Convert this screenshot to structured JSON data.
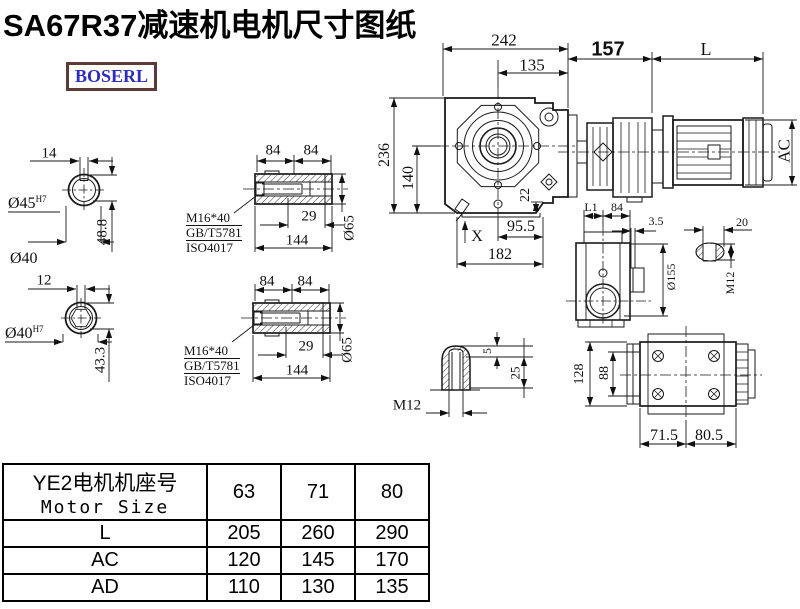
{
  "title": "SA67R37减速机电机尺寸图纸",
  "brand": {
    "logo_text": "BOSERL",
    "logo_color": "#2a2ad0",
    "border_color": "#5d3a3a"
  },
  "views": {
    "shaft_end_a": {
      "keyway_width": "14",
      "bore_dia": "Ø45",
      "bore_fit": "H7",
      "depth": "48.8",
      "outer_dia": "Ø40"
    },
    "shaft_end_b": {
      "keyway_width": "12",
      "bore_dia": "Ø40",
      "bore_fit": "H7",
      "depth": "43.3"
    },
    "hollow_shaft_a": {
      "half_len_1": "84",
      "half_len_2": "84",
      "bolt_len": "29",
      "total_len": "144",
      "outer_dia": "Ø65",
      "bolt_spec": "M16*40",
      "bolt_std_1": "GB/T5781",
      "bolt_std_2": "ISO4017"
    },
    "hollow_shaft_b": {
      "half_len_1": "84",
      "half_len_2": "84",
      "bolt_len": "29",
      "total_len": "144",
      "outer_dia": "Ø65",
      "bolt_spec": "M16*40",
      "bolt_std_1": "GB/T5781",
      "bolt_std_2": "ISO4017"
    },
    "front_view": {
      "overall_width": "242",
      "center_to_flange": "135",
      "gear_unit_len": "157",
      "motor_len": "L",
      "overall_height": "236",
      "center_height": "140",
      "foot_height": "22",
      "foot_to_center": "95.5",
      "base_width": "182",
      "x_mark": "X",
      "motor_dia": "AC"
    },
    "side_view": {
      "dim_l1": "L1",
      "flange_w": "84",
      "plate_t": "3.5",
      "flange_dia": "Ø155",
      "key_len": "20",
      "thread": "M12"
    },
    "key_section": {
      "key_height": "5",
      "key_depth": "25",
      "thread": "M12"
    },
    "bottom_view": {
      "overall_h": "128",
      "bolt_span": "88",
      "left_len": "71.5",
      "right_len": "80.5"
    }
  },
  "table": {
    "header_cn": "YE2电机机座号",
    "header_en": "Motor Size",
    "columns": [
      "63",
      "71",
      "80"
    ],
    "rows": [
      {
        "label": "L",
        "values": [
          "205",
          "260",
          "290"
        ]
      },
      {
        "label": "AC",
        "values": [
          "120",
          "145",
          "170"
        ]
      },
      {
        "label": "AD",
        "values": [
          "110",
          "130",
          "135"
        ]
      }
    ]
  }
}
